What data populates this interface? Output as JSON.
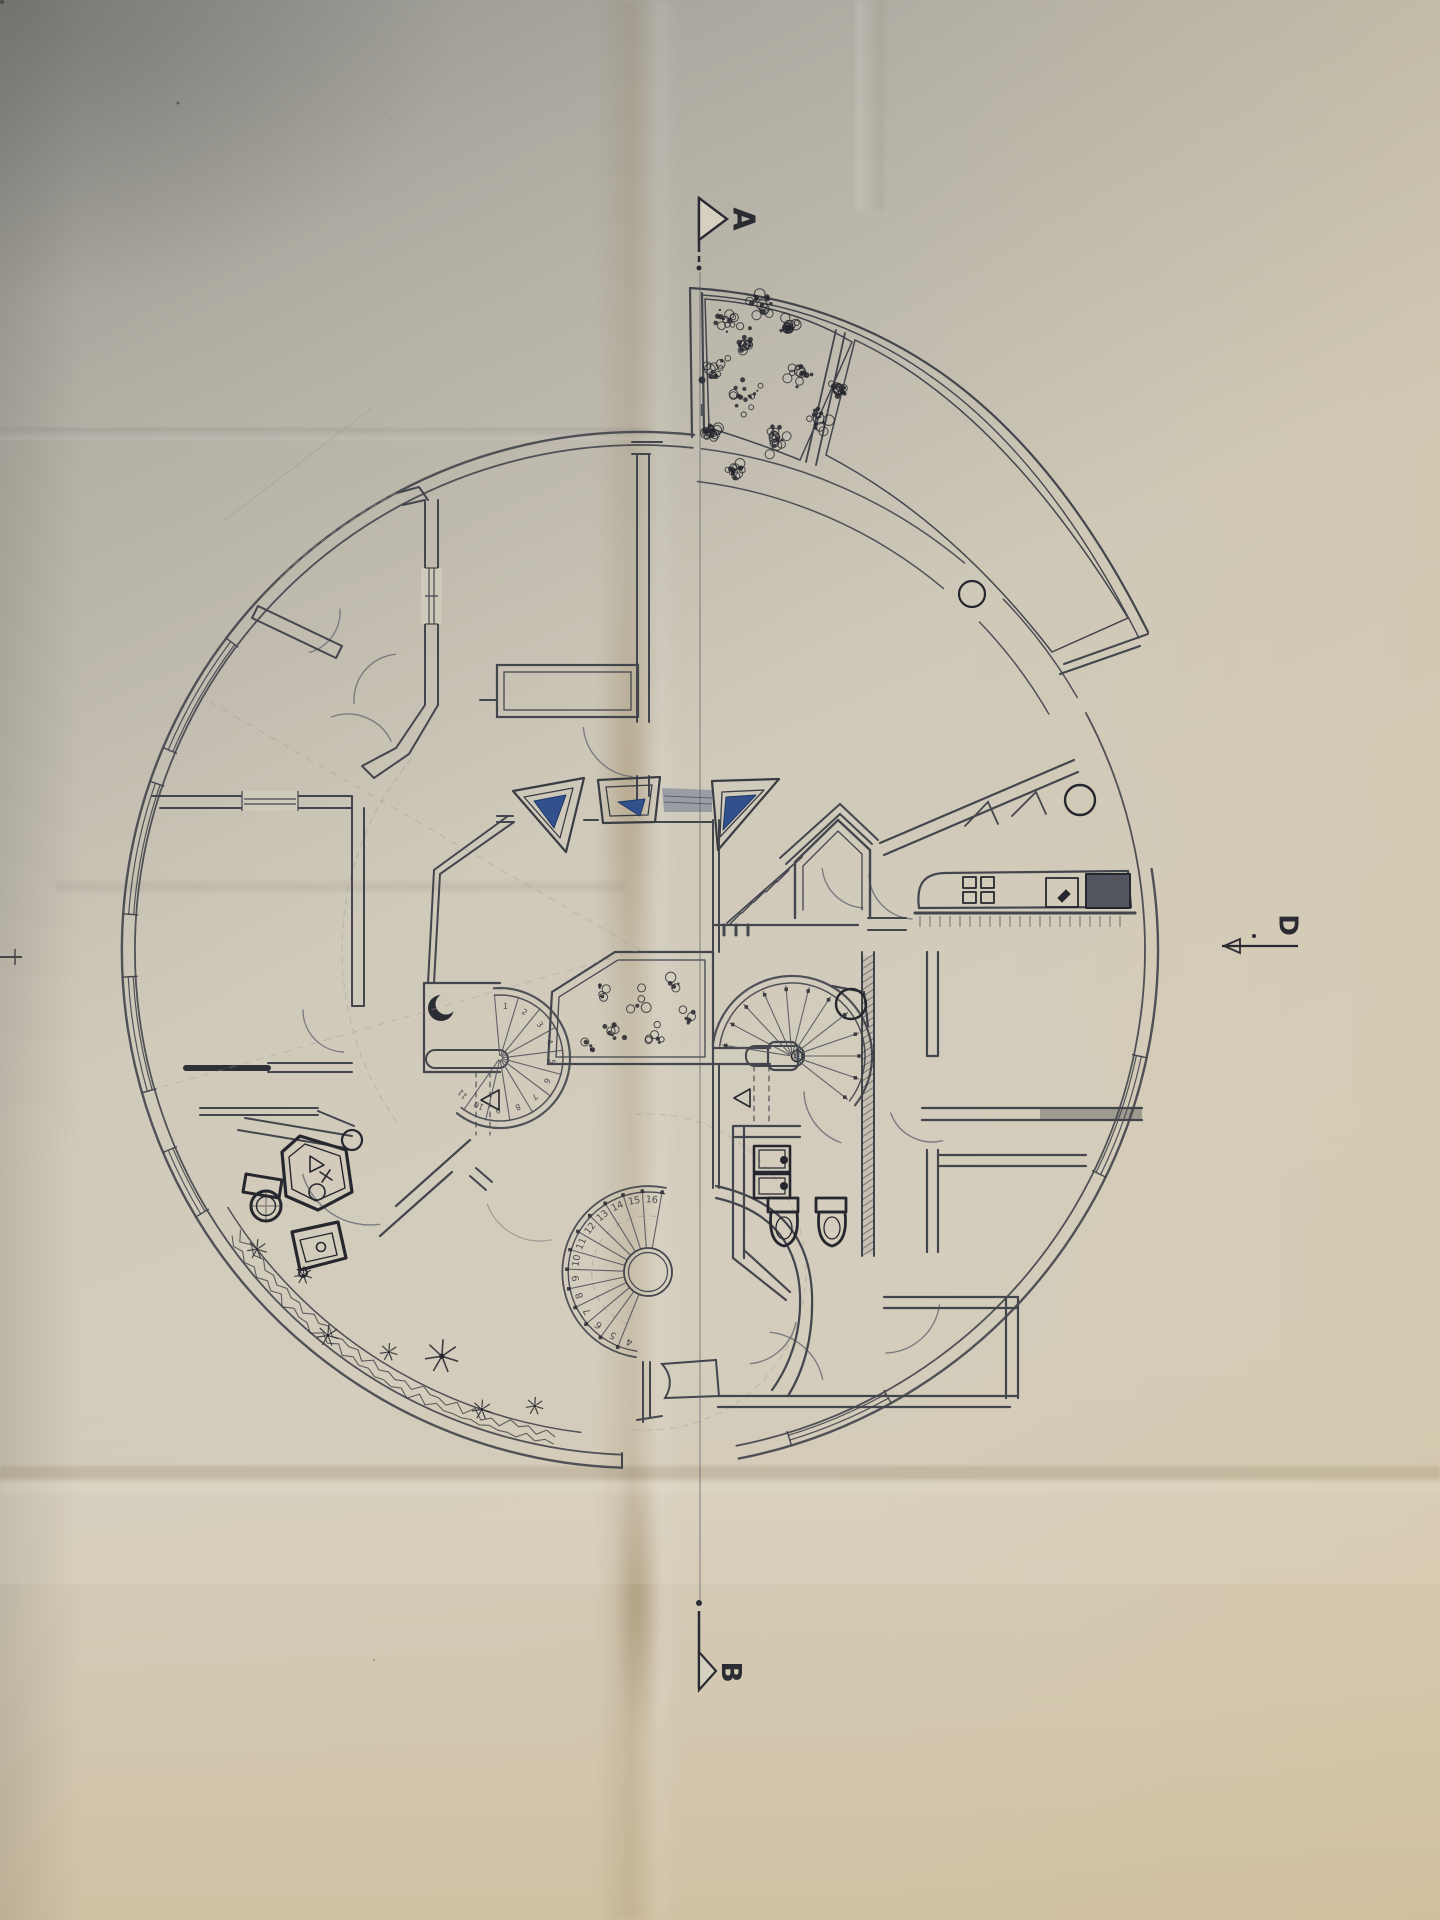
{
  "photo": {
    "description": "hand-drawn circular house floor plan photographed on folded paper"
  },
  "markers": {
    "a": {
      "label": "A"
    },
    "b": {
      "label": "B"
    },
    "d": {
      "label": "D"
    }
  },
  "colors": {
    "paper": "#cfc9ba",
    "ink": "#44464e",
    "ink_heavy": "#26272e",
    "ink_faint": "#a19c8c",
    "door": "#72757b",
    "glass_blue": "#32508c",
    "glass_blue_dark": "#1f3766",
    "shade_gray": "#9096a0",
    "counter_dark": "#53565e"
  },
  "stairs": {
    "left": {
      "cx": 500,
      "cy": 1058,
      "tread_r": 64,
      "num_r": 52,
      "start": 95,
      "step": -22,
      "count": 11,
      "numbers": [
        "1",
        "2",
        "3",
        "4",
        "5",
        "6",
        "7",
        "8",
        "9",
        "10",
        "11"
      ]
    },
    "right": {
      "cx": 792,
      "cy": 1056,
      "tread_r": 71,
      "dot_r": 67,
      "start": 171,
      "step": -19,
      "count": 12,
      "numbers": []
    },
    "bottom": {
      "cx": 648,
      "cy": 1272,
      "hub_r": 24,
      "tread_r": 83,
      "num_r": 72,
      "dot_r": 81,
      "start": 80,
      "step": 14,
      "count": 13,
      "numbers": [
        "16",
        "15",
        "14",
        "13",
        "12",
        "11",
        "10",
        "9",
        "8",
        "7",
        "6",
        "5",
        "4"
      ]
    }
  },
  "arcs": [
    {
      "n": "outer-wall-left",
      "cx": 640,
      "cy": 950,
      "r": 518,
      "a1": 118,
      "a2": 268,
      "w": 2.4
    },
    {
      "n": "outer-wall-left-in",
      "cx": 640,
      "cy": 950,
      "r": 505,
      "a1": 118,
      "a2": 268,
      "w": 1.8
    },
    {
      "n": "outer-wall-right",
      "cx": 640,
      "cy": 950,
      "r": 518,
      "a1": 281,
      "a2": 369,
      "w": 2.4
    },
    {
      "n": "outer-wall-right-in",
      "cx": 640,
      "cy": 950,
      "r": 505,
      "a1": 281,
      "a2": 388,
      "w": 1.8
    },
    {
      "n": "outer-wall-top",
      "cx": 640,
      "cy": 950,
      "r": 518,
      "a1": 84,
      "a2": 118,
      "w": 2.4
    },
    {
      "n": "outer-wall-top-in",
      "cx": 640,
      "cy": 950,
      "r": 505,
      "a1": 84,
      "a2": 118,
      "w": 1.8
    },
    {
      "n": "terrace-corridor-1",
      "cx": 640,
      "cy": 950,
      "r": 505,
      "a1": 30,
      "a2": 44,
      "w": 1.5
    },
    {
      "n": "terrace-corridor-2",
      "cx": 640,
      "cy": 950,
      "r": 505,
      "a1": 50,
      "a2": 83,
      "w": 1.5
    },
    {
      "n": "terrace-corridor-3",
      "cx": 640,
      "cy": 950,
      "r": 472,
      "a1": 30,
      "a2": 44,
      "w": 1.5
    },
    {
      "n": "terrace-corridor-4",
      "cx": 640,
      "cy": 950,
      "r": 472,
      "a1": 50,
      "a2": 83,
      "w": 1.5
    },
    {
      "n": "plant-band-inner",
      "cx": 640,
      "cy": 950,
      "r": 486,
      "a1": 212,
      "a2": 263,
      "w": 1.5
    },
    {
      "n": "construct-hall",
      "cx": 640,
      "cy": 950,
      "r": 298,
      "a1": 140,
      "a2": 216,
      "w": 1,
      "dash": 1,
      "op": 0.5,
      "c": "#a19c8c"
    },
    {
      "n": "construct-bottom",
      "cx": 648,
      "cy": 1272,
      "r": 158,
      "a1": -95,
      "a2": 95,
      "w": 1,
      "dash": 1,
      "op": 0.45,
      "c": "#a19c8c"
    },
    {
      "n": "construct-top-left",
      "cx": 640,
      "cy": 950,
      "r": 518,
      "a1": 118,
      "a2": 134,
      "w": 1,
      "dash": 1,
      "op": 0.5,
      "c": "#a19c8c"
    },
    {
      "n": "stair-left-wall-out",
      "cx": 500,
      "cy": 1058,
      "r": 70,
      "a1": -128,
      "a2": 95,
      "w": 2.2
    },
    {
      "n": "stair-left-wall-in",
      "cx": 500,
      "cy": 1058,
      "r": 63,
      "a1": -128,
      "a2": 95,
      "w": 1.5
    },
    {
      "n": "stair-right-wall-out",
      "cx": 792,
      "cy": 1056,
      "r": 80,
      "a1": -38,
      "a2": 172,
      "w": 2.2
    },
    {
      "n": "stair-right-wall-in",
      "cx": 792,
      "cy": 1056,
      "r": 73,
      "a1": -38,
      "a2": 172,
      "w": 1.5
    },
    {
      "n": "stair-bottom-wall-out",
      "cx": 648,
      "cy": 1272,
      "r": 86,
      "a1": 78,
      "a2": 262,
      "w": 1.8
    },
    {
      "n": "stair-bottom-wall-in",
      "cx": 648,
      "cy": 1272,
      "r": 80,
      "a1": 78,
      "a2": 262,
      "w": 1.4
    },
    {
      "n": "stair-bottom-walkline",
      "cx": 648,
      "cy": 1272,
      "r": 56,
      "a1": 82,
      "a2": 250,
      "w": 1,
      "dash": 1,
      "op": 0.6,
      "c": "#a19c8c"
    },
    {
      "n": "door-left-room",
      "cx": 345,
      "cy": 1010,
      "r": 42,
      "a1": 180,
      "a2": 268,
      "w": 1.4,
      "c": "#72757b"
    },
    {
      "n": "door-bath",
      "cx": 370,
      "cy": 1155,
      "r": 70,
      "a1": 196,
      "a2": 278,
      "w": 1.4,
      "c": "#72757b"
    },
    {
      "n": "door-hall-1",
      "cx": 400,
      "cy": 700,
      "r": 46,
      "a1": 96,
      "a2": 184,
      "w": 1.4,
      "c": "#72757b"
    },
    {
      "n": "door-hall-2",
      "cx": 348,
      "cy": 762,
      "r": 48,
      "a1": 26,
      "a2": 110,
      "w": 1.4,
      "c": "#72757b"
    },
    {
      "n": "door-hall-3",
      "cx": 298,
      "cy": 612,
      "r": 42,
      "a1": 286,
      "a2": 364,
      "w": 1.4,
      "c": "#72757b"
    },
    {
      "n": "door-wedge-room",
      "cx": 638,
      "cy": 722,
      "r": 55,
      "a1": 186,
      "a2": 264,
      "w": 1.4,
      "c": "#72757b"
    },
    {
      "n": "door-vestibule",
      "cx": 866,
      "cy": 864,
      "r": 44,
      "a1": 186,
      "a2": 266,
      "w": 1.4,
      "c": "#72757b"
    },
    {
      "n": "door-kitchen",
      "cx": 915,
      "cy": 873,
      "r": 46,
      "a1": 182,
      "a2": 266,
      "w": 1.4,
      "c": "#72757b"
    },
    {
      "n": "door-right-1",
      "cx": 932,
      "cy": 1098,
      "r": 44,
      "a1": 200,
      "a2": 284,
      "w": 1.4,
      "c": "#72757b"
    },
    {
      "n": "door-right-2",
      "cx": 860,
      "cy": 1090,
      "r": 56,
      "a1": 182,
      "a2": 250,
      "w": 1.4,
      "c": "#72757b"
    },
    {
      "n": "door-right-3",
      "cx": 884,
      "cy": 1297,
      "r": 56,
      "a1": 272,
      "a2": 352,
      "w": 1.4,
      "c": "#72757b"
    },
    {
      "n": "door-bottom-1",
      "cx": 764,
      "cy": 1392,
      "r": 60,
      "a1": 12,
      "a2": 84,
      "w": 1.4,
      "c": "#72757b"
    },
    {
      "n": "door-sanitary",
      "cx": 745,
      "cy": 1312,
      "r": 52,
      "a1": 276,
      "a2": 348,
      "w": 1.4,
      "c": "#72757b"
    },
    {
      "n": "door-left-lower",
      "cx": 540,
      "cy": 1185,
      "r": 56,
      "a1": 200,
      "a2": 282,
      "w": 1.2,
      "op": 0.55,
      "c": "#72757b"
    }
  ],
  "glazing": {
    "cx": 640,
    "cy": 950,
    "radii": [
      507.5,
      512.5
    ],
    "spans": [
      [
        143,
        157
      ],
      [
        161,
        176
      ],
      [
        183,
        196
      ],
      [
        203,
        211
      ],
      [
        -12,
        -26
      ],
      [
        287,
        299
      ]
    ]
  },
  "hatch": {
    "kitchen": {
      "x1": 920,
      "x2": 1128,
      "y": 916,
      "len": 11,
      "step": 10
    },
    "shaft": {
      "x1": 862,
      "x2": 874,
      "y1": 956,
      "y2": 1254,
      "step": 7
    }
  },
  "plants": {
    "seed": 7,
    "terrace_clusters": [
      [
        730,
        320,
        22
      ],
      [
        762,
        305,
        16
      ],
      [
        718,
        368,
        14
      ],
      [
        746,
        398,
        20
      ],
      [
        800,
        372,
        18
      ],
      [
        776,
        440,
        16
      ],
      [
        820,
        420,
        13
      ],
      [
        745,
        344,
        12
      ],
      [
        710,
        432,
        10
      ],
      [
        838,
        390,
        10
      ],
      [
        788,
        328,
        12
      ],
      [
        735,
        468,
        10
      ]
    ],
    "interior_clusters": [
      [
        600,
        990,
        12
      ],
      [
        640,
        1000,
        13
      ],
      [
        672,
        986,
        11
      ],
      [
        616,
        1030,
        12
      ],
      [
        656,
        1036,
        12
      ],
      [
        686,
        1018,
        10
      ],
      [
        592,
        1046,
        9
      ]
    ],
    "band": {
      "cx": 640,
      "cy": 950,
      "r1": 489,
      "r2": 506,
      "a1": 215,
      "a2": 261
    },
    "daisies": [
      [
        218,
        486,
        10
      ],
      [
        224,
        468,
        9
      ],
      [
        231,
        496,
        11
      ],
      [
        238,
        474,
        9
      ],
      [
        244,
        452,
        17
      ],
      [
        251,
        486,
        10
      ],
      [
        257,
        468,
        9
      ]
    ]
  }
}
